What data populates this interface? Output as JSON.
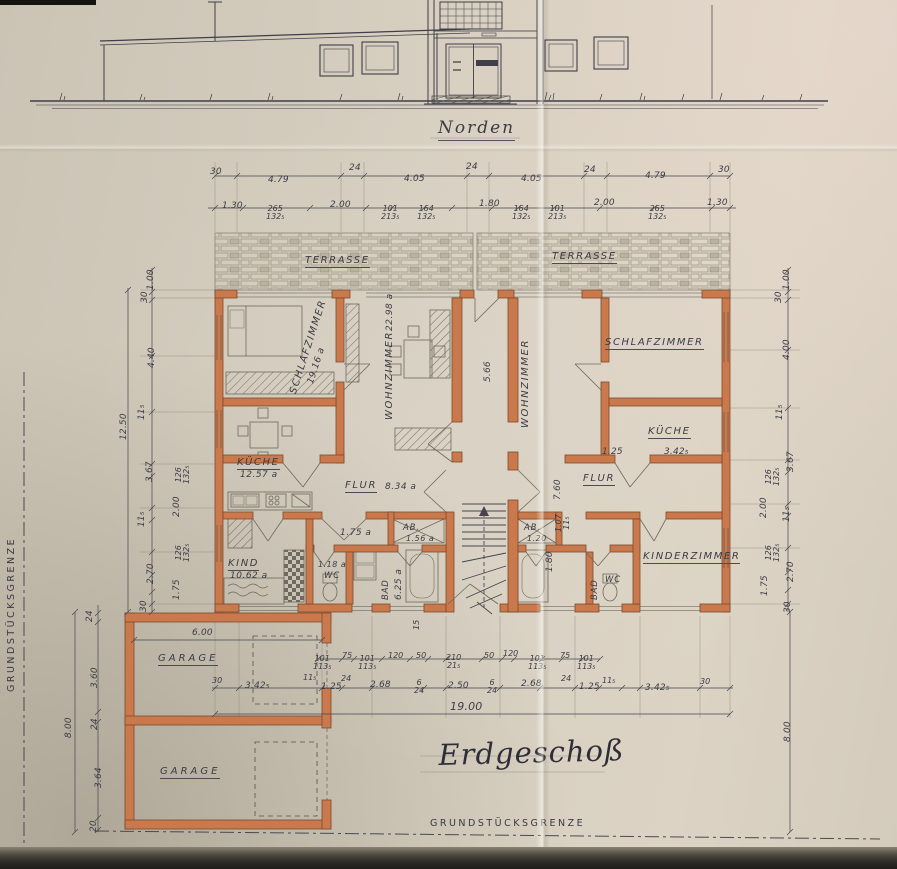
{
  "elevation": {
    "caption": "Norden"
  },
  "plan": {
    "title": "Erdgeschoß",
    "boundary_left": "GRUNDSTÜCKSGRENZE",
    "boundary_bottom": "GRUNDSTÜCKSGRENZE",
    "terrace_left": "TERRASSE",
    "terrace_right": "TERRASSE",
    "garage_top": "GARAGE",
    "garage_bottom": "GARAGE"
  },
  "rooms": {
    "schlafzimmer_left": {
      "label": "SCHLAFZIMMER",
      "area": "19.16 a"
    },
    "wohnzimmer_left": {
      "label": "WOHNZIMMER",
      "area": "22.98 a"
    },
    "kueche_left": {
      "label": "KÜCHE",
      "area": "12.57 a"
    },
    "flur_left": {
      "label": "FLUR",
      "area": "8.34 a"
    },
    "kind_left": {
      "label": "KIND",
      "area": "10.62 a"
    },
    "wc_left": {
      "label": "WC",
      "area": "1.18 a"
    },
    "bad_left": {
      "label": "BAD",
      "area": "6.25 a"
    },
    "ab_left": {
      "label": "AB.",
      "area": "1.56 a"
    },
    "vorraum_left": {
      "area": "1.75 a"
    },
    "wohnzimmer_right": {
      "label": "WOHNZIMMER"
    },
    "schlafzimmer_right": {
      "label": "SCHLAFZIMMER"
    },
    "kueche_right": {
      "label": "KÜCHE"
    },
    "flur_right": {
      "label": "FLUR"
    },
    "ab_right": {
      "label": "AB.",
      "area": "1.20"
    },
    "bad_right": {
      "label": "BAD"
    },
    "wc_right": {
      "label": "WC"
    },
    "kinderzimmer_right": {
      "label": "KINDERZIMMER"
    }
  },
  "dims": {
    "top1": [
      "30",
      "4.79",
      "24",
      "4.05",
      "24",
      "4.05",
      "24",
      "4.79",
      "30"
    ],
    "top2": [
      "1.30",
      {
        "a": "265",
        "b": "132₅"
      },
      "2.00",
      {
        "a": "101",
        "b": "213₅"
      },
      {
        "a": "164",
        "b": "132₅"
      },
      "1.80",
      {
        "a": "164",
        "b": "132₅"
      },
      {
        "a": "101",
        "b": "213₅"
      },
      "2.00",
      {
        "a": "265",
        "b": "132₅"
      },
      "1.30"
    ],
    "left": [
      "1.00",
      "30",
      "4.40",
      "11₅",
      "12.50",
      "3.67",
      {
        "a": "126",
        "b": "132₅"
      },
      "2.00",
      "11₅",
      {
        "a": "126",
        "b": "132₅"
      },
      "2.70",
      "1.75",
      "30"
    ],
    "right": [
      "1.00",
      "30",
      "4.00",
      "11₅",
      "3.67",
      {
        "a": "126",
        "b": "132₅"
      },
      "2.00",
      "11₅",
      {
        "a": "126",
        "b": "132₅"
      },
      "2.70",
      "1.75",
      "30",
      "8.00"
    ],
    "left_garage": [
      "24",
      "3.60",
      "24",
      "8.00",
      "3.64",
      "20",
      "6.00"
    ],
    "bottomA": [
      {
        "a": "101",
        "b": "113₅"
      },
      "75",
      {
        "a": "101",
        "b": "113₅"
      },
      "120",
      "50",
      {
        "a": "210",
        "b": "21₅"
      },
      "50",
      "120",
      {
        "a": "101",
        "b": "113₅"
      },
      "75",
      {
        "a": "101",
        "b": "113₅"
      }
    ],
    "bottomB": [
      "30",
      "3.42₅",
      "11₅",
      "1.25",
      "24",
      "2.68",
      {
        "a": "6",
        "b": "24"
      },
      "2.50",
      {
        "a": "6",
        "b": "24"
      },
      "2.68",
      "24",
      "1.25",
      "11₅",
      "3.42₅",
      "30"
    ],
    "total_width": "19.00",
    "interior": {
      "hall": "5.66",
      "kueche_r_door": "1.25",
      "kueche_r_width": "3.42₅",
      "v1": "7.60",
      "v2a": "1.07",
      "v2b": "11₅",
      "v3": "1.80",
      "step": "15"
    }
  }
}
